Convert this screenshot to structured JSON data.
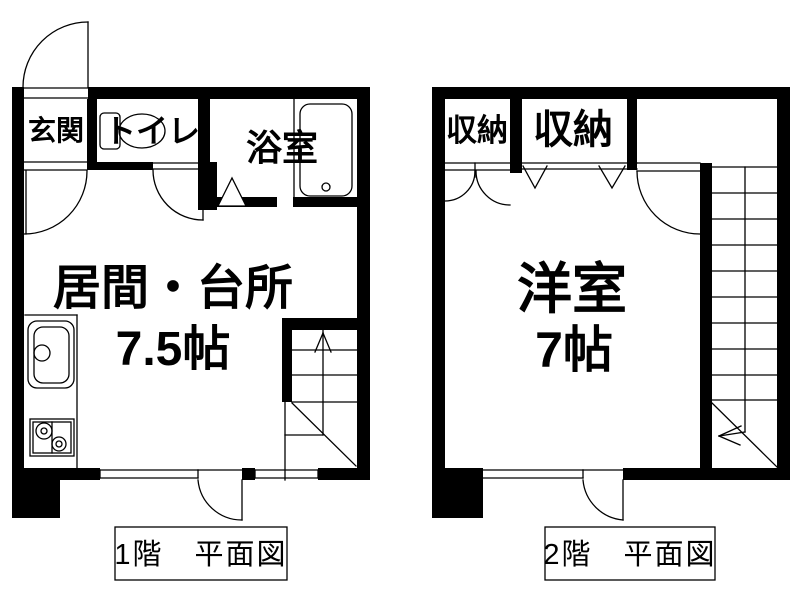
{
  "page": {
    "background_color": "#ffffff",
    "ink_color": "#000000",
    "type": "apartment floor plan, two floors side by side"
  },
  "floor1": {
    "caption": "1階　平面図",
    "rooms": {
      "genkan": "玄関",
      "toilet": "トイレ",
      "bath": "浴室",
      "living_kitchen": "居間・台所",
      "living_kitchen_size": "7.5帖"
    }
  },
  "floor2": {
    "caption": "2階　平面図",
    "rooms": {
      "closet_left": "収納",
      "closet_right": "収納",
      "western_room": "洋室",
      "western_room_size": "7帖"
    }
  }
}
